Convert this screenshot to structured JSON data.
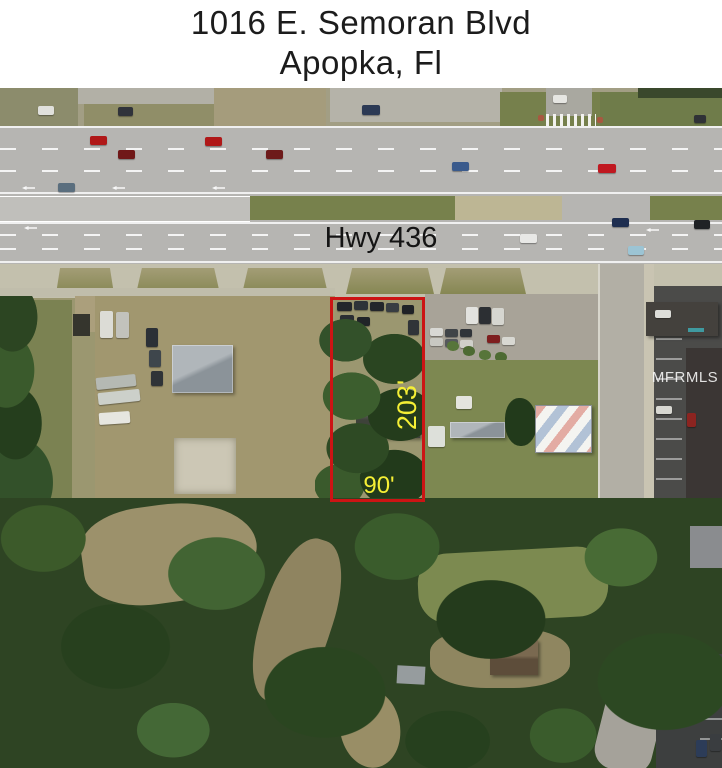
{
  "title": {
    "line1": "1016 E. Semoran Blvd",
    "line2": "Apopka, Fl"
  },
  "map": {
    "road_label": "Hwy 436",
    "watermark": "MFRMLS",
    "parcel": {
      "depth_label": "203'",
      "width_label": "90'"
    }
  },
  "colors": {
    "boundary": "#cc1414",
    "dimension_text": "#f5ef35",
    "title_text": "#1c1c1c",
    "road_label_text": "#141414",
    "watermark_text": "#ffffff"
  }
}
